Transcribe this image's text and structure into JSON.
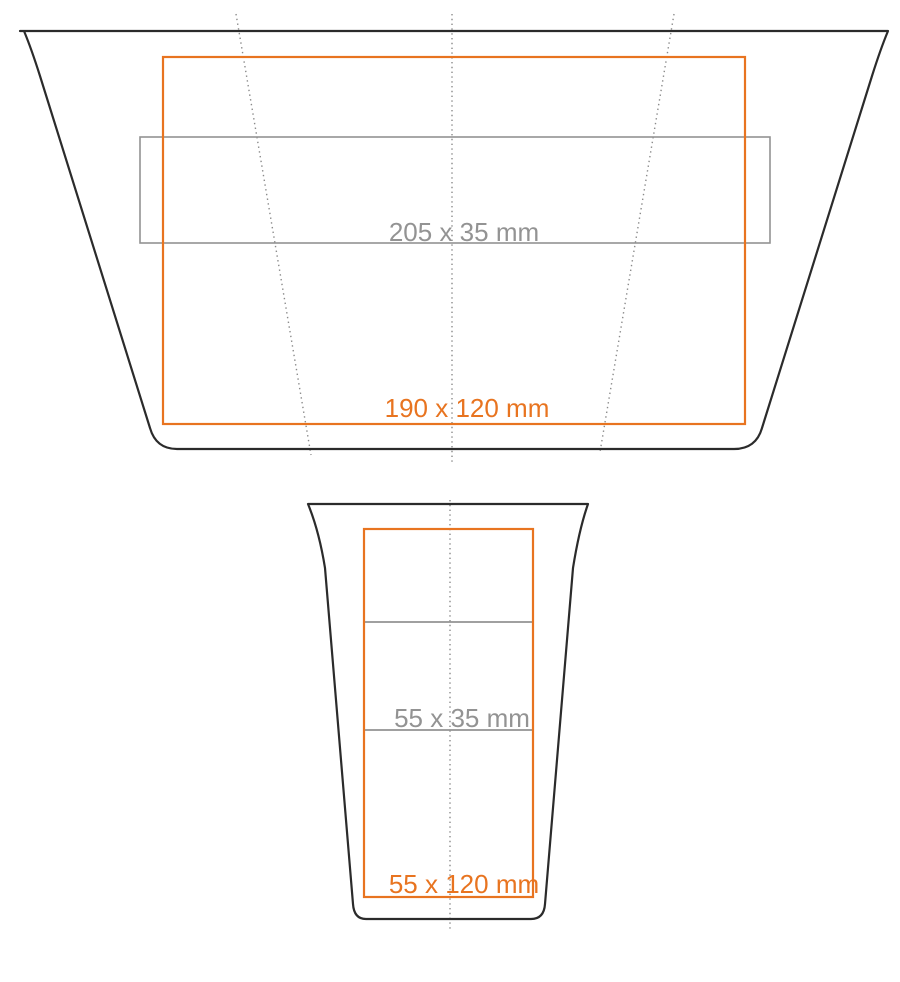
{
  "diagram": {
    "title": "cup imprint area template",
    "unfolded_view": {
      "name": "unfolded cup surface (top view)",
      "strip_area_label": "205 x 35 mm",
      "max_area_label": "190 x 120 mm"
    },
    "side_view": {
      "name": "cup side profile (front view)",
      "strip_area_label": "55 x 35 mm",
      "max_area_label": "55 x 120 mm"
    }
  },
  "colors": {
    "outline": "#2b2b2b",
    "orange": "#e87420",
    "gray": "#939393",
    "dotted": "#8a8a8a",
    "background": "#ffffff"
  }
}
